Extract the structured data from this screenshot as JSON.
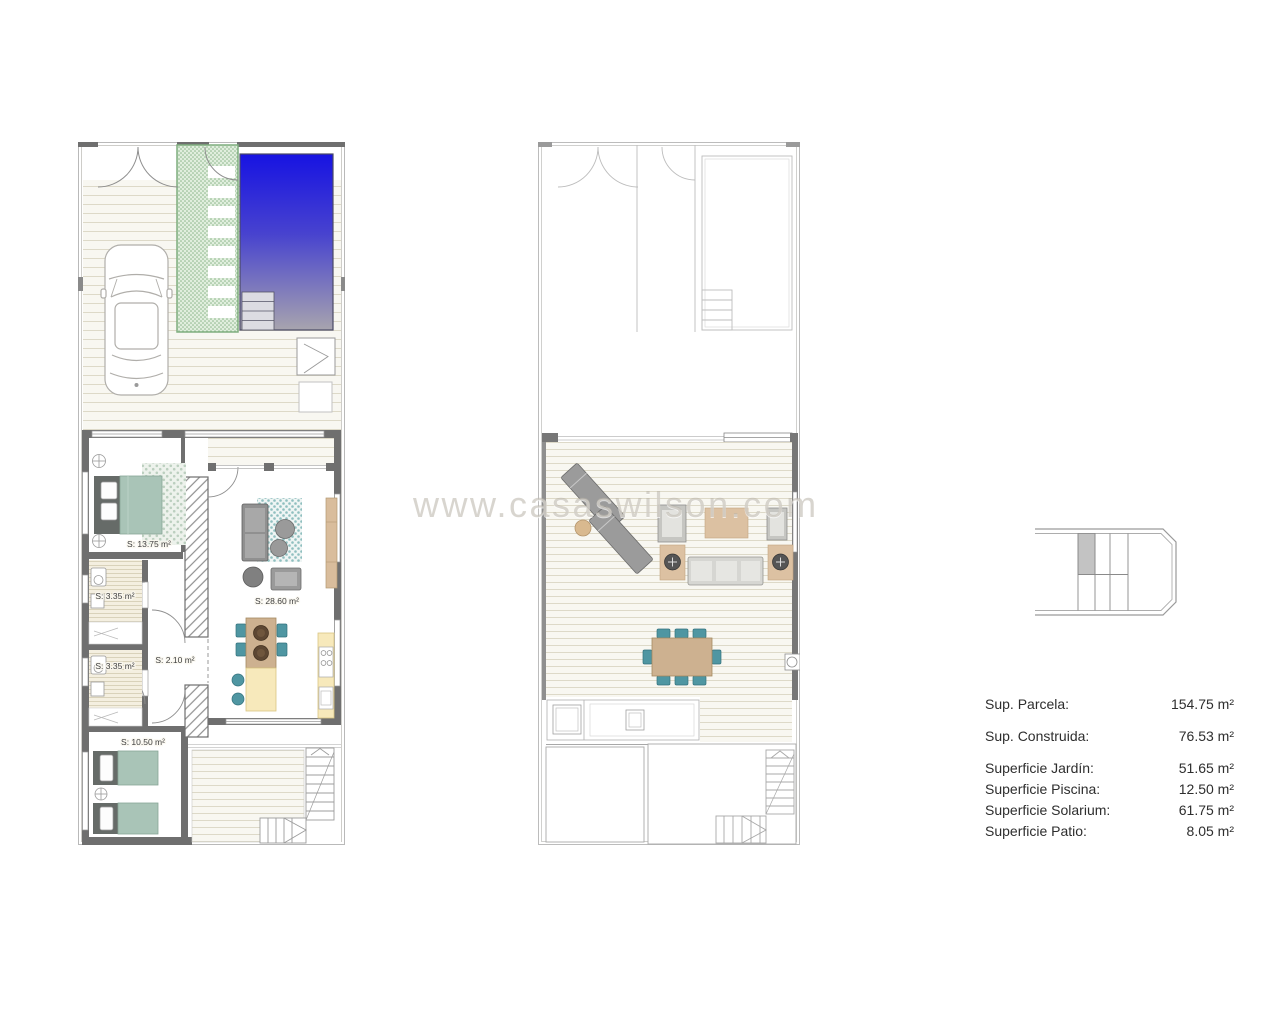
{
  "watermark": "www.casaswilson.com",
  "ground_floor": {
    "labels": {
      "master_bedroom": "S: 13.75 m²",
      "bathroom_1": "S: 3.35 m²",
      "bathroom_2": "S: 3.35 m²",
      "hall": "S: 2.10 m²",
      "living_kitchen": "S: 28.60 m²",
      "bedroom_2": "S: 10.50 m²"
    }
  },
  "areas_table": {
    "rows": [
      {
        "label": "Sup. Parcela:",
        "value": "154.75 m²"
      },
      {
        "label": "Sup. Construida:",
        "value": "76.53 m²"
      },
      {
        "label": "Superficie Jardín:",
        "value": "51.65 m²"
      },
      {
        "label": "Superficie Piscina:",
        "value": "12.50 m²"
      },
      {
        "label": "Superficie Solarium:",
        "value": "61.75 m²"
      },
      {
        "label": "Superficie Patio:",
        "value": "8.05 m²"
      }
    ]
  },
  "colors": {
    "pool_blue": "#1713e2",
    "garden_path_green": "#e0eedd",
    "bed_sage": "#a9c4b7",
    "accent_teal": "#4f96a2",
    "wood_tan": "#cdb190",
    "kitchen_yellow": "#f7e9bb"
  }
}
